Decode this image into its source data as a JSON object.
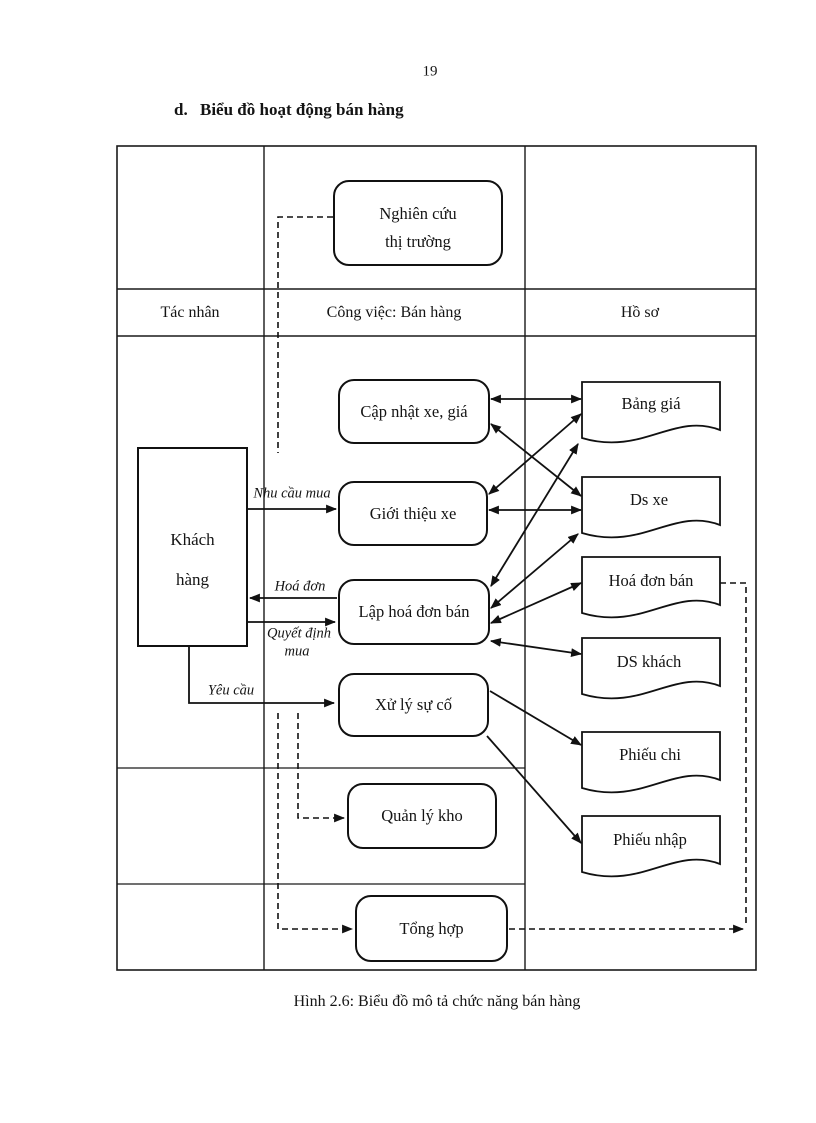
{
  "page": {
    "number": "19",
    "heading_marker": "d.",
    "heading": "Biểu đồ hoạt động bán hàng",
    "caption": "Hình 2.6: Biểu đồ mô tả chức năng bán hàng"
  },
  "diagram": {
    "lanes": {
      "actor": "Tác nhân",
      "work": "Công việc: Bán hàng",
      "records": "Hồ sơ"
    },
    "actor_box": {
      "line1": "Khách",
      "line2": "hàng"
    },
    "activities": {
      "nghien_cuu_1": "Nghiên cứu",
      "nghien_cuu_2": "thị trường",
      "cap_nhat": "Cập nhật xe, giá",
      "gioi_thieu": "Giới thiệu xe",
      "lap_hoa_don": "Lập hoá đơn bán",
      "xu_ly": "Xử lý sự cố",
      "quan_ly_kho": "Quản lý kho",
      "tong_hop": "Tổng hợp"
    },
    "documents": {
      "bang_gia": "Bảng giá",
      "ds_xe": "Ds xe",
      "hoa_don_ban": "Hoá đơn bán",
      "ds_khach": "DS khách",
      "phieu_chi": "Phiếu chi",
      "phieu_nhap": "Phiếu nhập"
    },
    "flow_labels": {
      "nhu_cau": "Nhu cầu mua",
      "hoa_don": "Hoá đơn",
      "quyet_dinh_1": "Quyết định",
      "quyet_dinh_2": "mua",
      "yeu_cau": "Yêu cầu"
    },
    "colors": {
      "ink": "#141414",
      "paper": "#ffffff"
    }
  }
}
